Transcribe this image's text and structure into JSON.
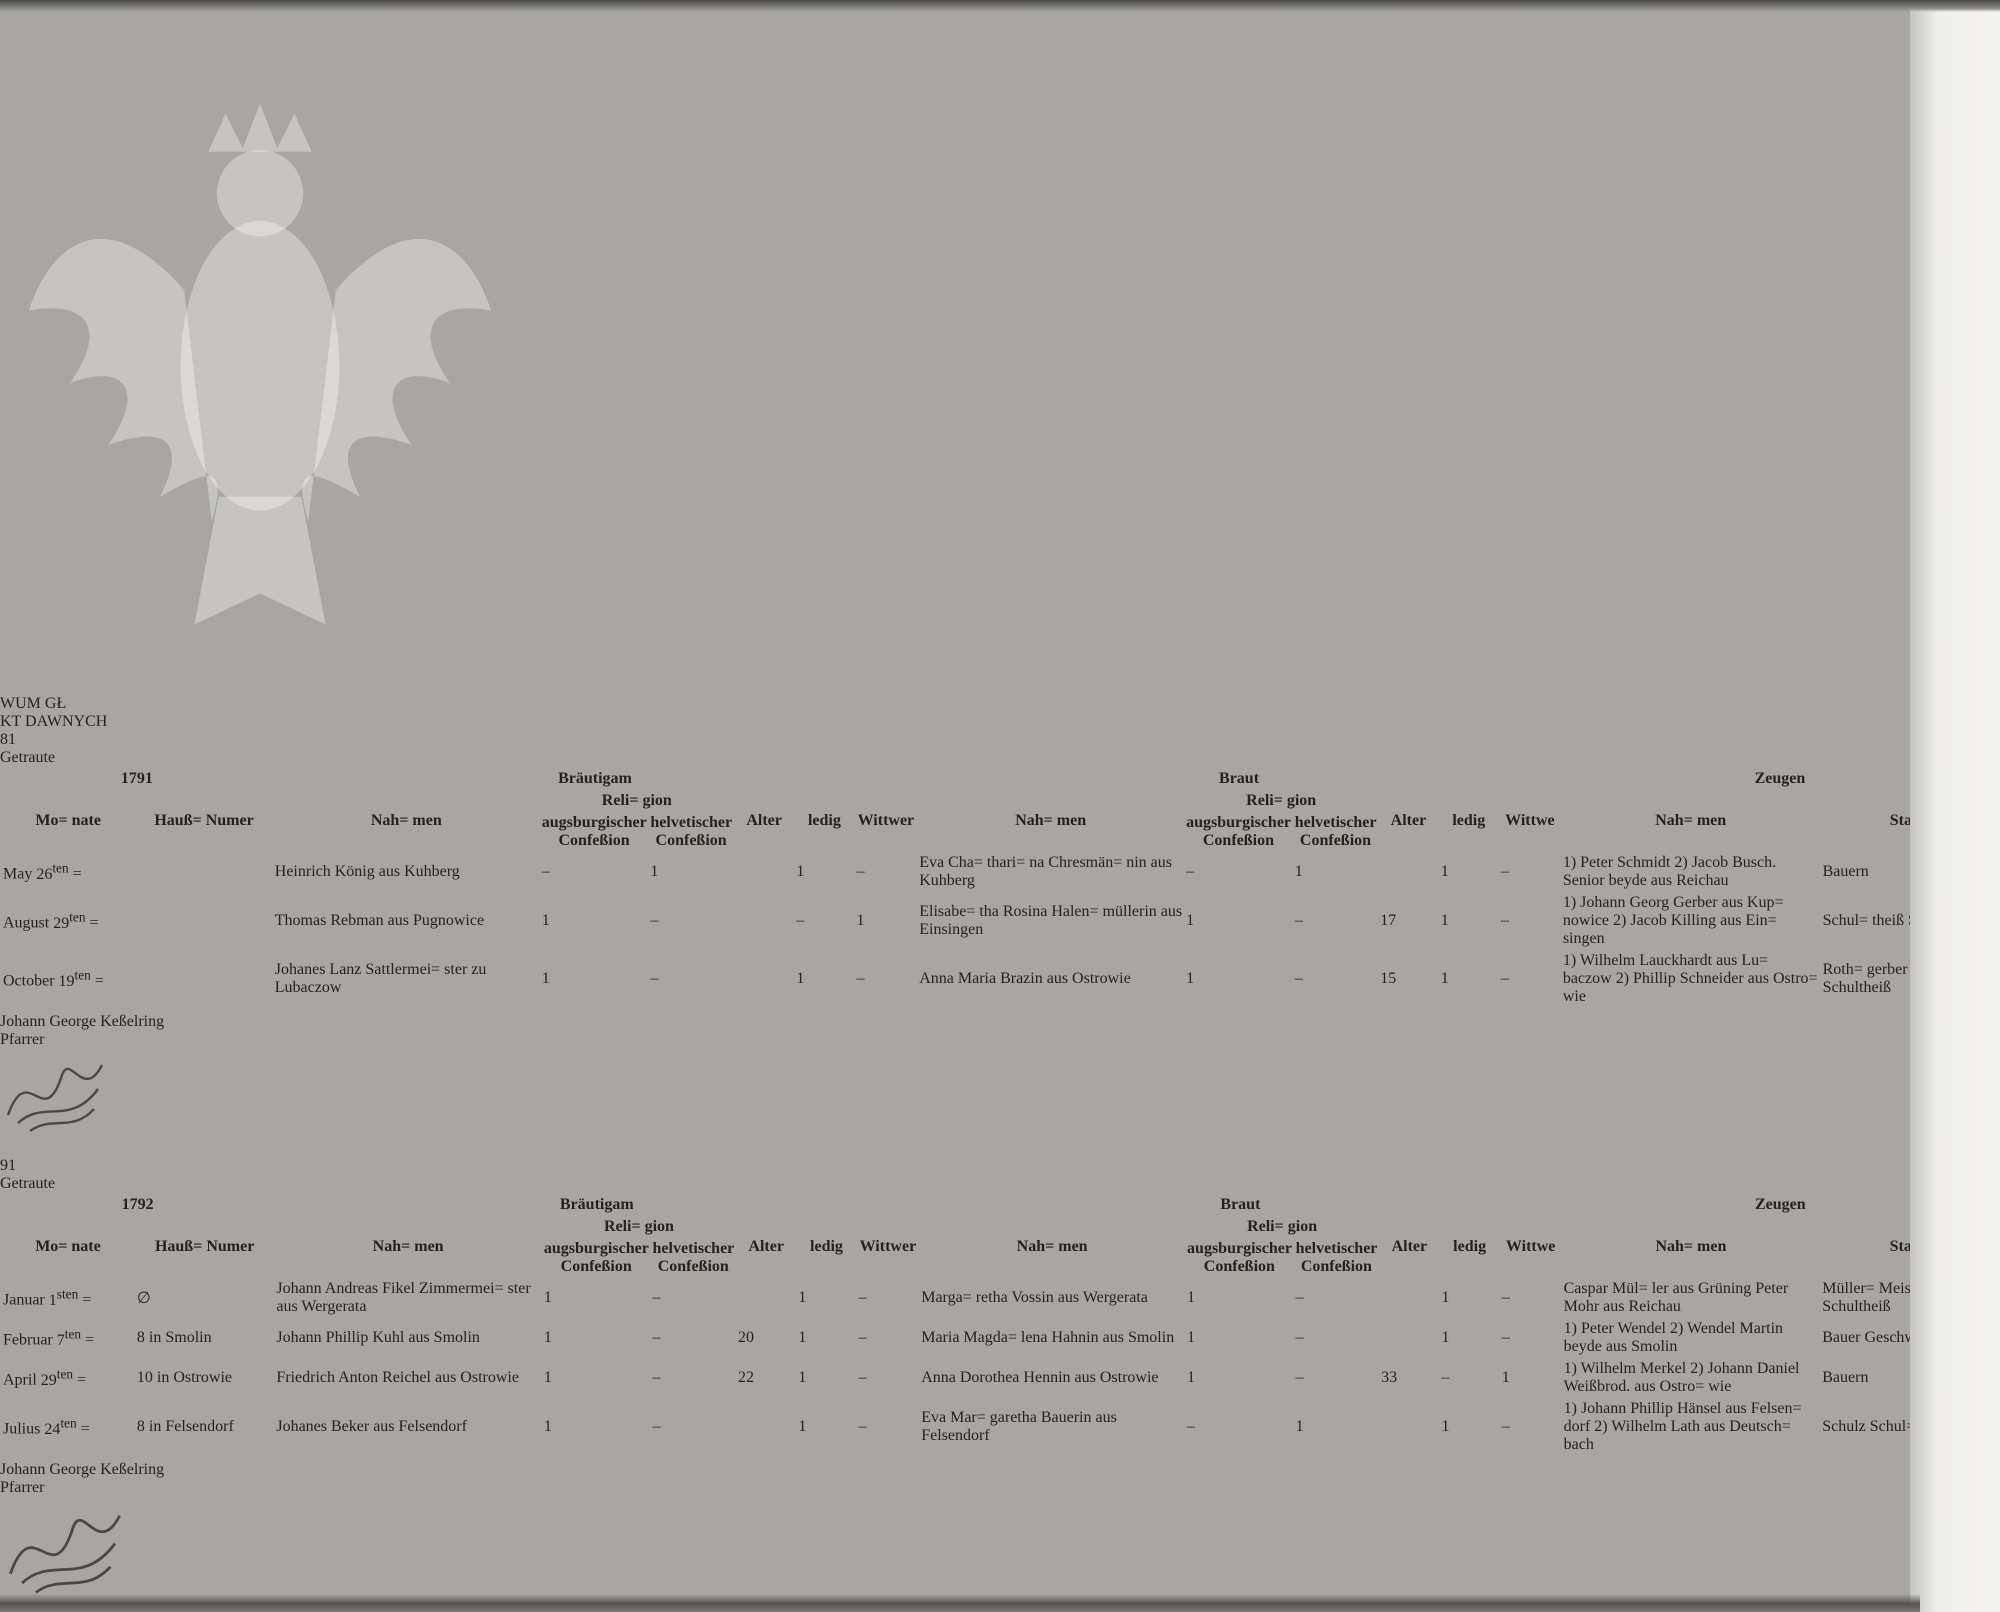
{
  "watermark": {
    "text": "Archiwum Główne Akt Dawnych",
    "fragments": [
      "WUM GŁ",
      "KT DAWNYCH"
    ]
  },
  "labels": {
    "groom": "Bräutigam",
    "bride": "Braut",
    "witnesses": "Zeugen",
    "month": "Mo=\nnate",
    "house": "Hauß=\nNumer",
    "name": "Nah=\nmen",
    "religion": "Reli=\ngion",
    "conf_augsburg": "augsburgischer Confeßion",
    "conf_helvetic": "helvetischer Confeßion",
    "age": "Alter",
    "single": "ledig",
    "widower": "Wittwer",
    "widow": "Wittwe",
    "stand": "Stand",
    "day_mark": "="
  },
  "page_left": {
    "page_number": "81",
    "heading": "Getraute",
    "year": "1791",
    "rows": [
      {
        "month": "May",
        "day": "26",
        "day_suffix": "ten",
        "house": "",
        "groom": "Heinrich\nKönig\naus\nKuhberg",
        "gm": [
          "–",
          "1",
          "",
          "1",
          "–"
        ],
        "bride": "Eva Cha=\nthari=\nna\nChresmän=\nnin\naus\nKuhberg",
        "bm": [
          "–",
          "1",
          "",
          "1",
          "–"
        ],
        "witnesses": "1) Peter\nSchmidt\n2) Jacob\nBusch.\nSenior\nbeyde aus\nReichau",
        "stand": "Bauern"
      },
      {
        "month": "August",
        "day": "29",
        "day_suffix": "ten",
        "house": "",
        "groom": "Thomas\nRebman\naus\nPugnowice",
        "gm": [
          "1",
          "–",
          "",
          "–",
          "1"
        ],
        "bride": "Elisabe=\ntha\nRosina\nHalen=\nmüllerin\naus\nEinsingen",
        "bm": [
          "1",
          "–",
          "17",
          "1",
          "–"
        ],
        "witnesses": "1) Johann\nGeorg\nGerber\naus Kup=\nnowice\n2) Jacob\nKilling\naus Ein=\nsingen",
        "stand": "Schul=\ntheiß\n\n\nSchultheiß"
      },
      {
        "month": "October",
        "day": "19",
        "day_suffix": "ten",
        "house": "",
        "groom": "Johanes\nLanz\nSattlermei=\nster\nzu\nLubaczow",
        "gm": [
          "1",
          "–",
          "",
          "1",
          "–"
        ],
        "bride": "Anna\nMaria\nBrazin\naus\nOstrowie",
        "bm": [
          "1",
          "–",
          "15",
          "1",
          "–"
        ],
        "witnesses": "1) Wilhelm\nLauckhardt\naus Lu=\nbaczow\n2) Phillip\nSchneider\naus Ostro=\nwie",
        "stand": "Roth=\ngerber\nMeister\n\nSchultheiß"
      }
    ],
    "signature": {
      "name": "Johann George Keßelring",
      "title": "Pfarrer"
    }
  },
  "page_right": {
    "page_number": "91",
    "heading": "Getraute",
    "year": "1792",
    "rows": [
      {
        "month": "Januar",
        "day": "1",
        "day_suffix": "sten",
        "house": "∅",
        "groom": "Johann\nAndreas\nFikel\nZimmermei=\nster\naus\nWergerata",
        "gm": [
          "1",
          "–",
          "",
          "1",
          "–"
        ],
        "bride": "Marga=\nretha\nVossin\naus\nWergerata",
        "bm": [
          "1",
          "–",
          "",
          "1",
          "–"
        ],
        "witnesses": "Caspar Mül=\nler\naus Grüning\nPeter Mohr\naus Reichau",
        "stand": "Müller=\nMeister\n\nSchultheiß"
      },
      {
        "month": "Februar",
        "day": "7",
        "day_suffix": "ten",
        "house": "8\nin\nSmolin",
        "groom": "Johann\nPhillip\nKuhl\naus\nSmolin",
        "gm": [
          "1",
          "–",
          "20",
          "1",
          "–"
        ],
        "bride": "Maria\nMagda=\nlena\nHahnin\naus\nSmolin",
        "bm": [
          "1",
          "–",
          "",
          "1",
          "–"
        ],
        "witnesses": "1) Peter\nWendel\n2) Wendel\nMartin\nbeyde aus\nSmolin",
        "stand": "Bauer\n\nGeschwor=\nner"
      },
      {
        "month": "April",
        "day": "29",
        "day_suffix": "ten",
        "house": "10\nin\nOstrowie",
        "groom": "Friedrich\nAnton\nReichel\naus\nOstrowie",
        "gm": [
          "1",
          "–",
          "22",
          "1",
          "–"
        ],
        "bride": "Anna\nDorothea\nHennin\naus\nOstrowie",
        "bm": [
          "1",
          "–",
          "33",
          "–",
          "1"
        ],
        "witnesses": "1) Wilhelm\nMerkel\n2) Johann\nDaniel\nWeißbrod.\naus Ostro=\nwie",
        "stand": "Bauern"
      },
      {
        "month": "Julius",
        "day": "24",
        "day_suffix": "ten",
        "house": "8\nin\nFelsendorf",
        "groom": "Johanes\nBeker\naus\nFelsendorf",
        "gm": [
          "1",
          "–",
          "",
          "1",
          "–"
        ],
        "bride": "Eva Mar=\ngaretha\nBauerin\naus\nFelsendorf",
        "bm": [
          "–",
          "1",
          "",
          "1",
          "–"
        ],
        "witnesses": "1) Johann\nPhillip\nHänsel\naus Felsen=\ndorf\n2) Wilhelm\nLath\naus Deutsch=\nbach",
        "stand": "Schulz\n\n\nSchul=\nlehrer"
      }
    ],
    "signature": {
      "name": "Johann George Keßelring",
      "title": "Pfarrer"
    }
  }
}
